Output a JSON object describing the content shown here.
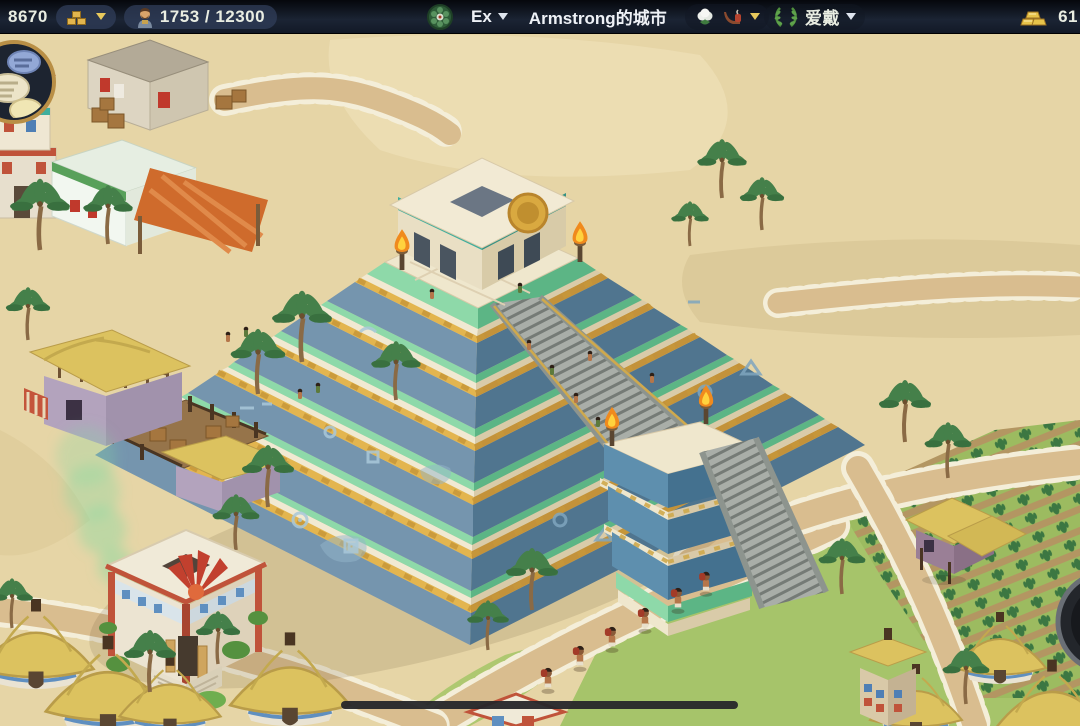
{
  "hud": {
    "coins": "8670",
    "population": "1753 / 12300",
    "city_level": "Ex",
    "city_name": "Armstrong的城市",
    "reputation": "爱戴",
    "gold": "61"
  },
  "icons": {
    "chat": "chat-bubbles",
    "construction": "building-blocks",
    "population": "citizen-avatar",
    "city_crest": "green-crest",
    "goods": [
      "cotton",
      "pipe"
    ],
    "reputation": "laurel-wreath",
    "gold": "gold-bars"
  },
  "palette": {
    "topbar_bg": "#141b29",
    "panel_bg": "#30445e",
    "hud_text": "#e9ede2",
    "hud_gold": "#e8c95c",
    "sand": "#e6d5a6",
    "road": "#d9bd8f",
    "road_stone": "#f4eed9",
    "grass": "#a6c46a",
    "pyramid_blue_light": "#7595ae",
    "pyramid_blue_dark": "#50758f",
    "pyramid_mint": "#8ed9a9",
    "pyramid_gold": "#e3b54f",
    "pyramid_cream": "#f1e9d2",
    "stairs": "#a9aea8",
    "thatch": "#dcc25f",
    "flame": "#f08a1d",
    "smoke_green": "#82d9a0"
  }
}
